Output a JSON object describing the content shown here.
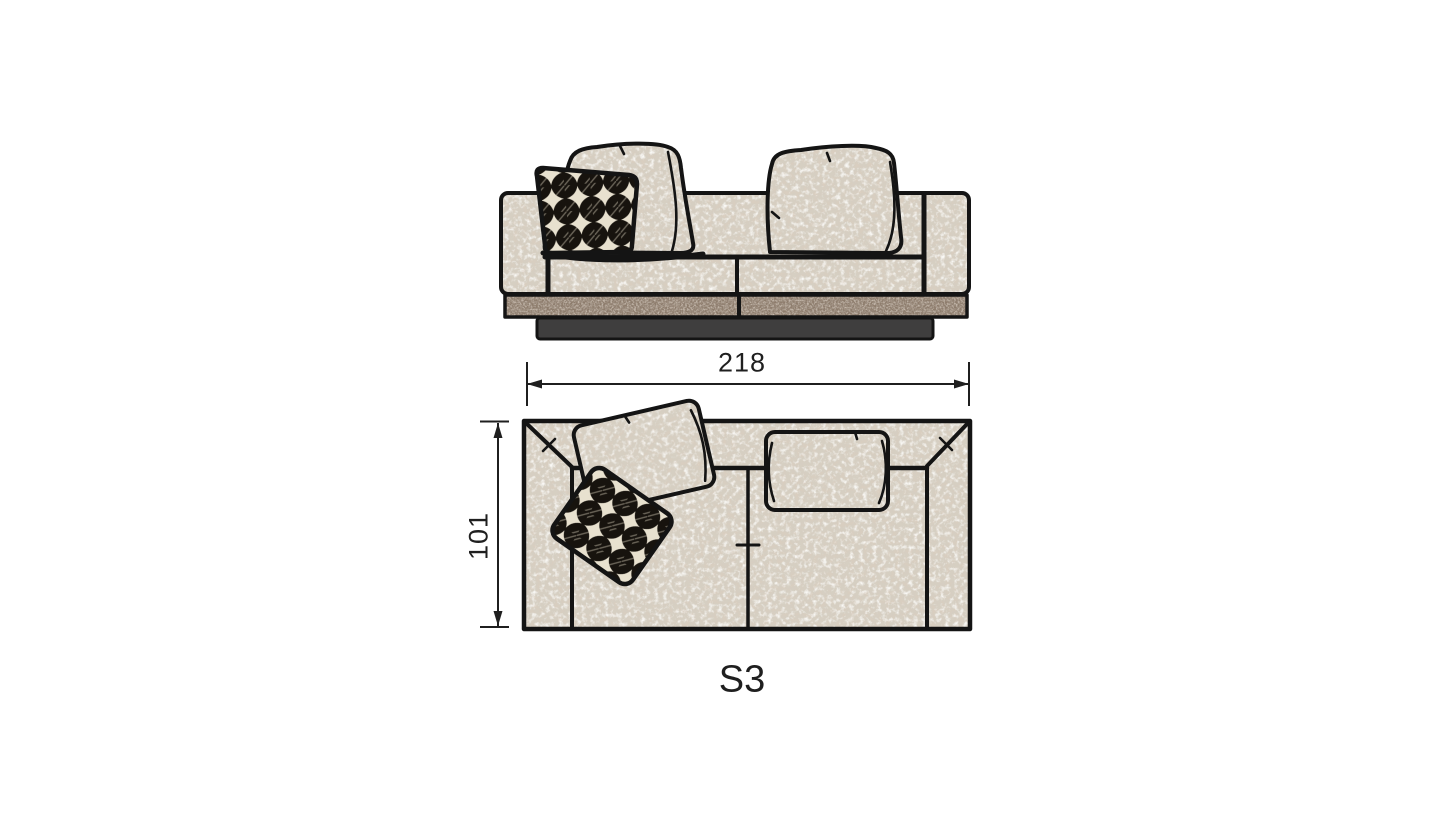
{
  "drawing": {
    "model_label": "S3",
    "dimensions": {
      "width": "218",
      "depth": "101"
    },
    "colors": {
      "background": "#ffffff",
      "outline": "#141414",
      "fabric_base": "#d6cfc2",
      "fabric_speckle_dark": "#b29d85",
      "fabric_speckle_light": "#f2efe8",
      "leather_base": "#8d7b6c",
      "plinth": "#3f3e3e",
      "pillow_black": "#17130e",
      "pillow_cream": "#e8e1cf",
      "dimension": "#1f1f1f"
    }
  }
}
